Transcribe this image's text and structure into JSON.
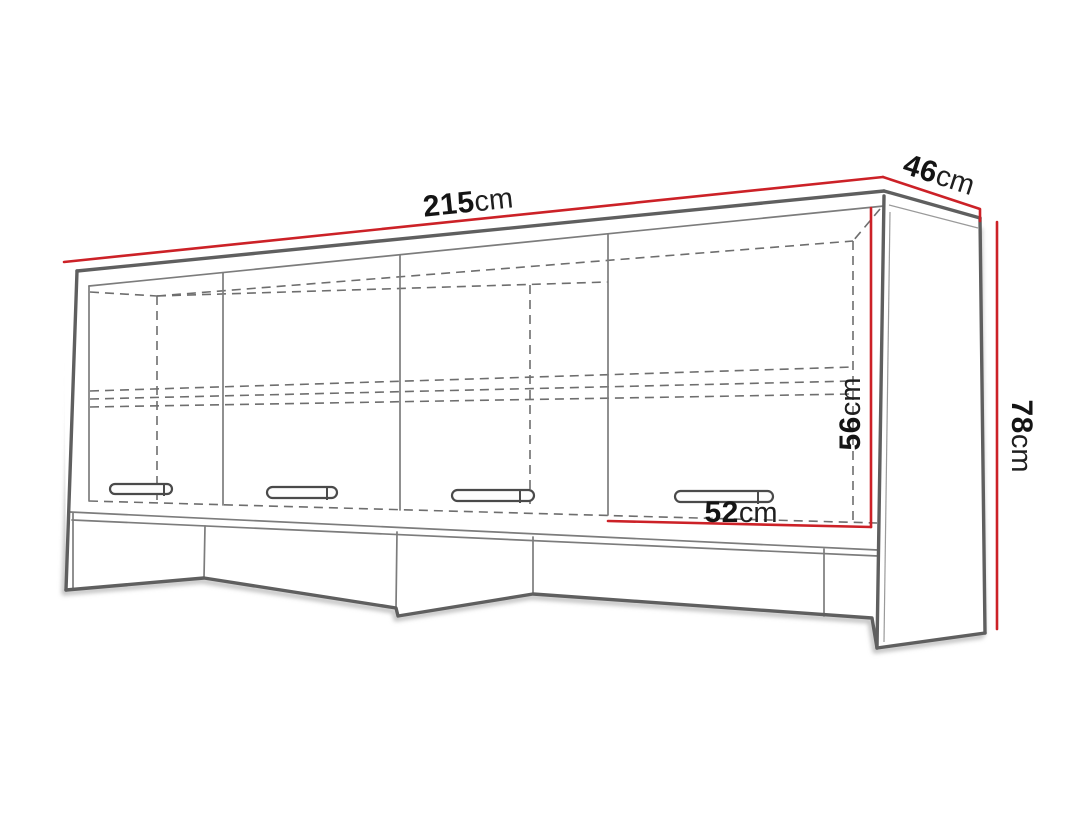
{
  "diagram": {
    "type": "furniture-dimension-drawing",
    "dimensions": {
      "width": {
        "value": "215",
        "unit": "cm"
      },
      "depth": {
        "value": "46",
        "unit": "cm"
      },
      "height": {
        "value": "78",
        "unit": "cm"
      },
      "opening_height": {
        "value": "56",
        "unit": "cm"
      },
      "opening_width": {
        "value": "52",
        "unit": "cm"
      }
    },
    "colors": {
      "dimension_line": "#cc2127",
      "outline": "#5f5f5f",
      "background": "#ffffff"
    }
  }
}
